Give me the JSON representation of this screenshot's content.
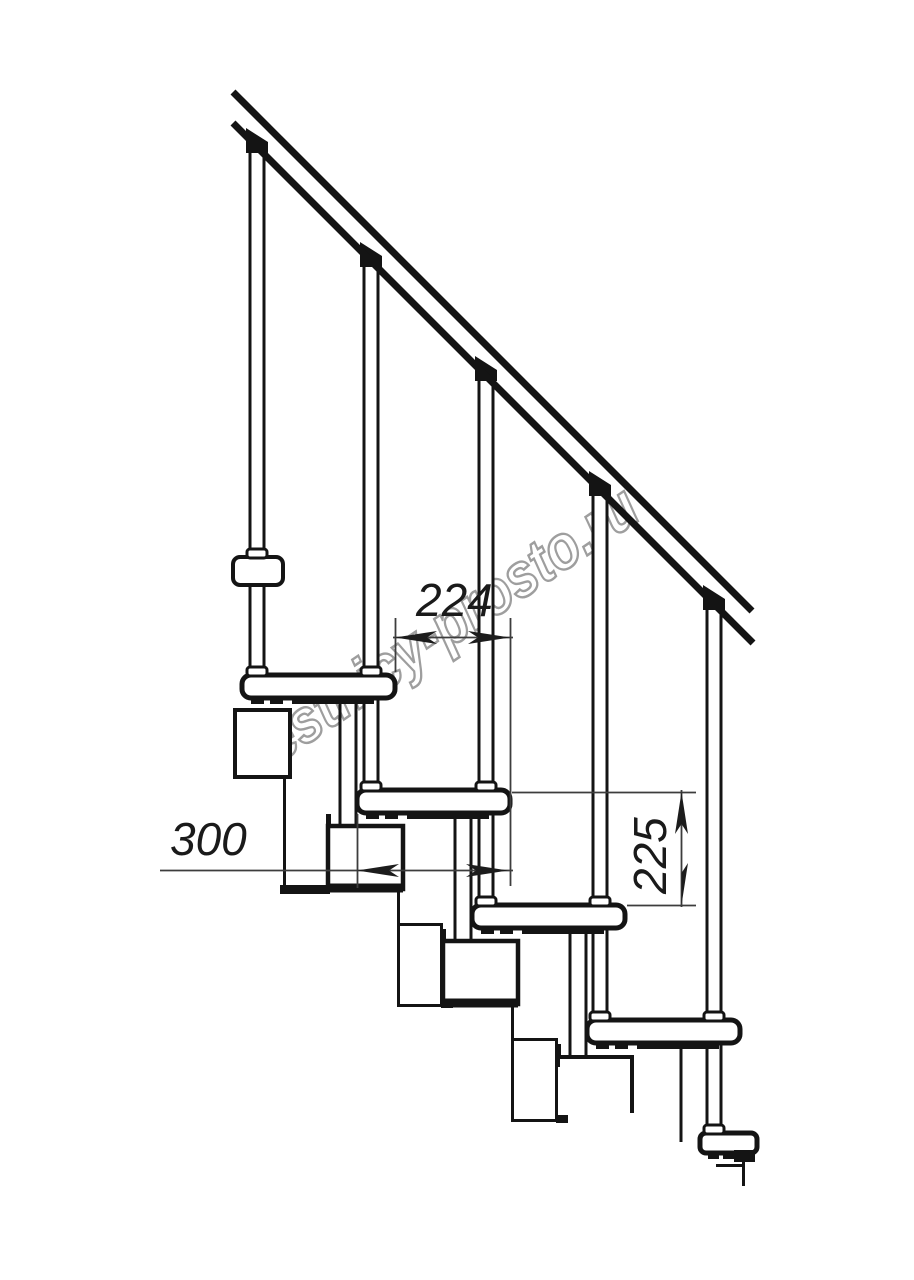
{
  "drawing": {
    "type": "staircase-side-elevation",
    "dimensions": {
      "going": "224",
      "tread_depth": "300",
      "rise": "225"
    },
    "watermark": {
      "text": "lestnicy-prosto.ru",
      "outline_color": "#9e9e9e",
      "fill_color": "rgba(255,255,255,0.72)"
    },
    "colors": {
      "background": "#ffffff",
      "ink": "#141414",
      "dimension_line": "#3d3d3d",
      "dimension_text": "#1a1a1a"
    }
  }
}
